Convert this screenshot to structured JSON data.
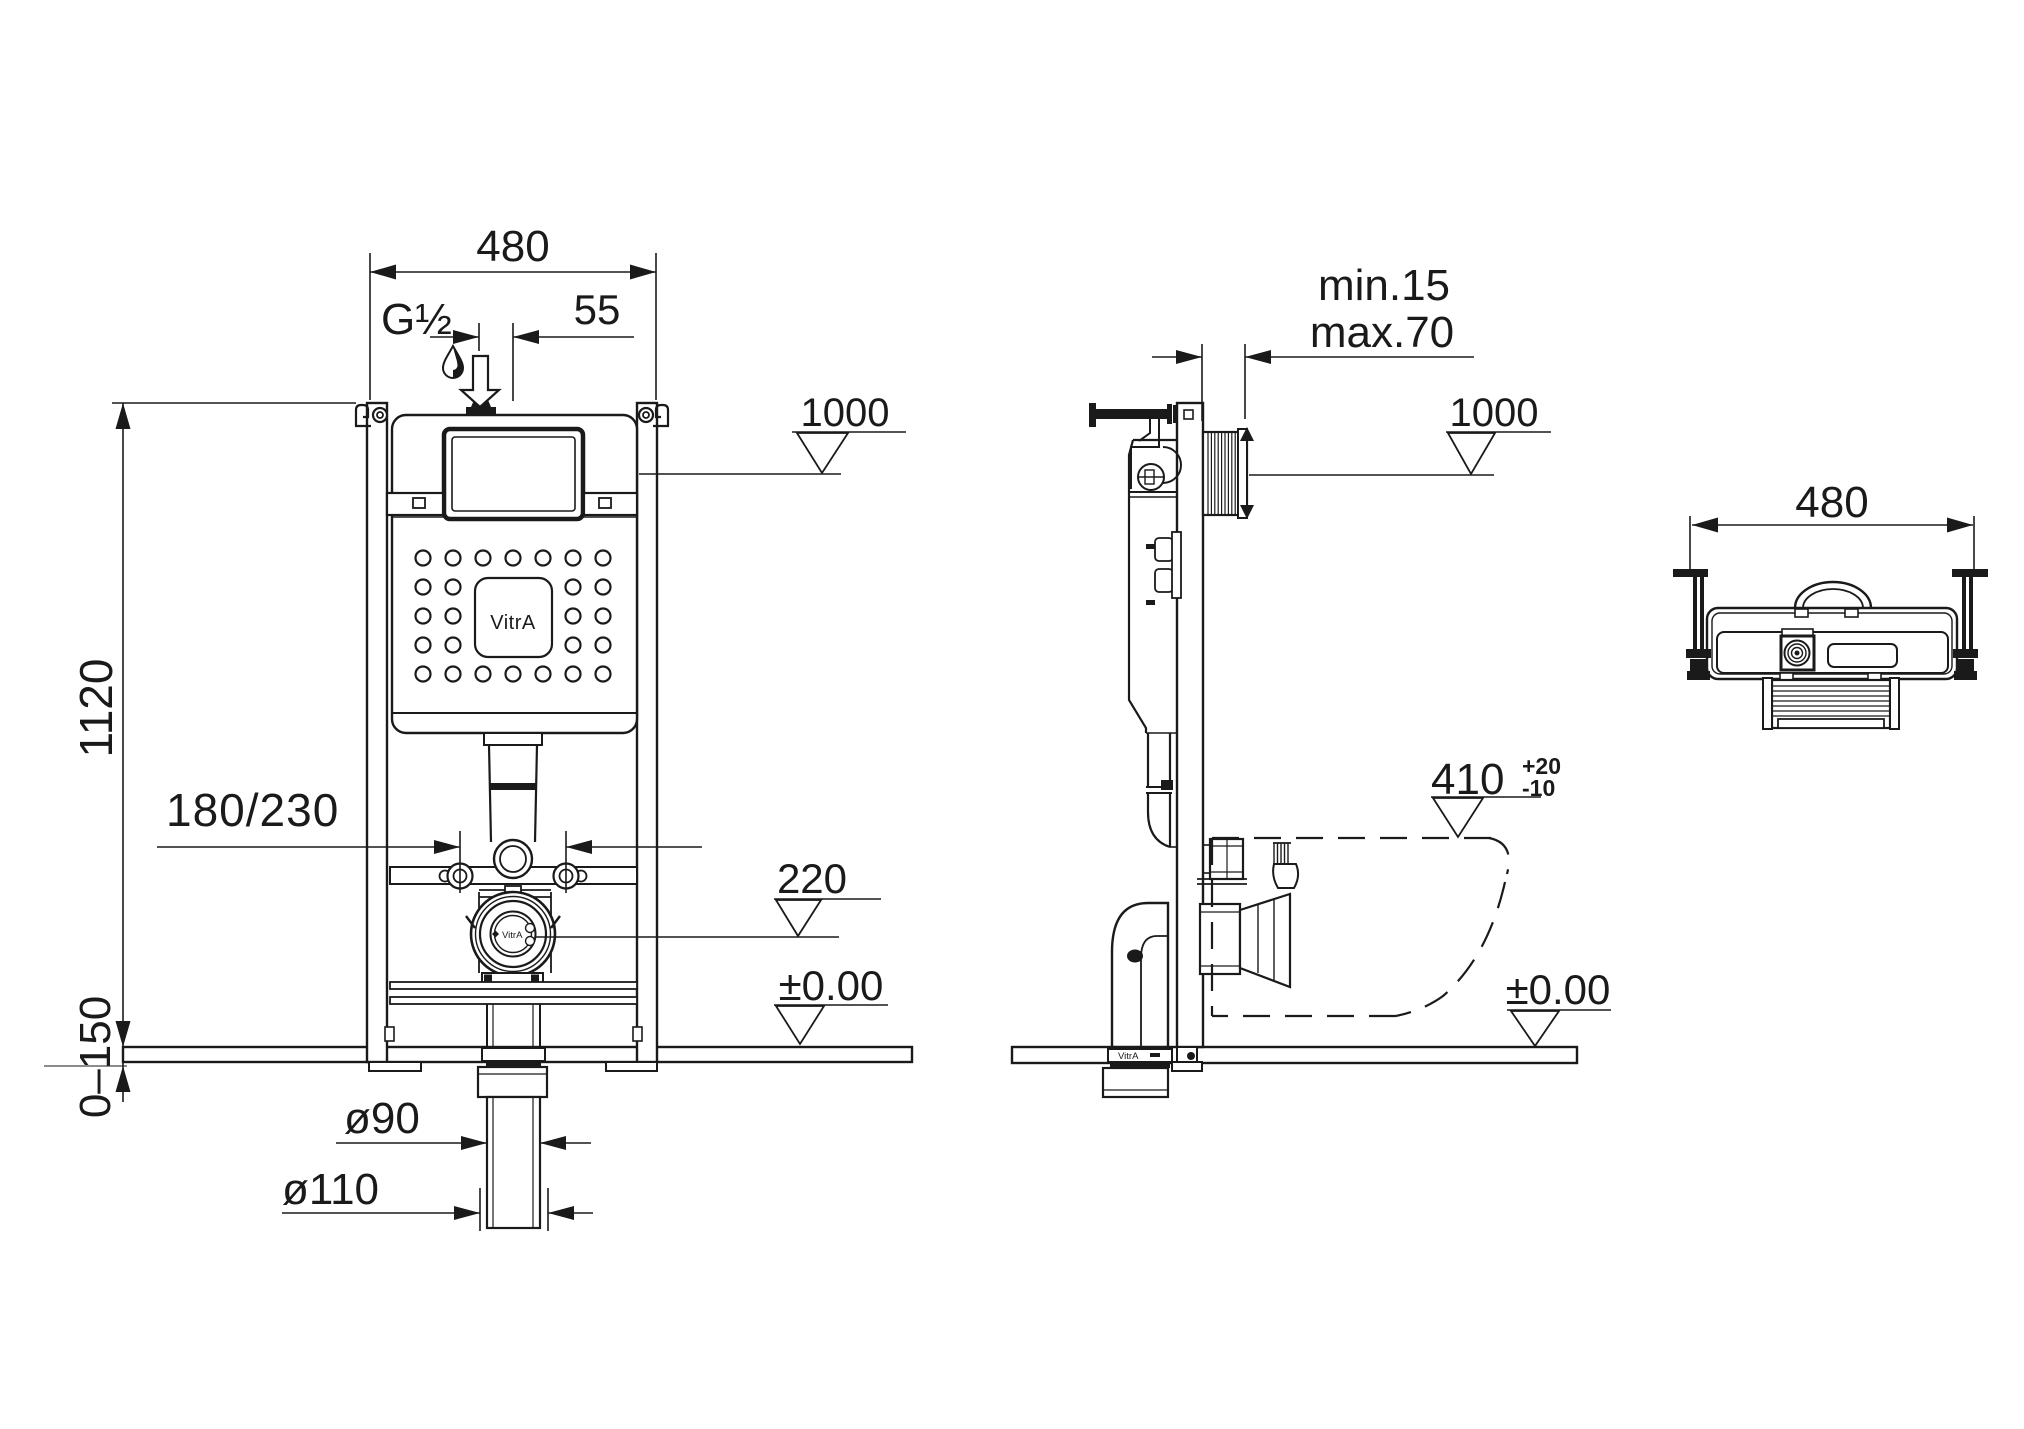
{
  "colors": {
    "ink": "#1a1a1a",
    "paper": "#ffffff"
  },
  "front_view": {
    "dim_width": "480",
    "inlet_thread": "G½",
    "dim_inlet_offset": "55",
    "level_cistern_top": "1000",
    "dim_frame_height": "1120",
    "dim_anchor_spacing": "180/230",
    "level_outlet": "220",
    "level_floor": "±0.00",
    "dim_floor_buildup": "0–150",
    "dia_outlet_inner": "ø90",
    "dia_outlet_outer": "ø110",
    "cistern_logo": "VitrA",
    "outlet_logo": "VitrA"
  },
  "side_view": {
    "dim_wall_min": "min.15",
    "dim_wall_max": "max.70",
    "level_cistern_top": "1000",
    "level_bowl_rim": "410",
    "bowl_tol_upper": "+20",
    "bowl_tol_lower": "-10",
    "level_floor": "±0.00",
    "elbow_logo": "VitrA"
  },
  "top_view": {
    "dim_width": "480"
  }
}
